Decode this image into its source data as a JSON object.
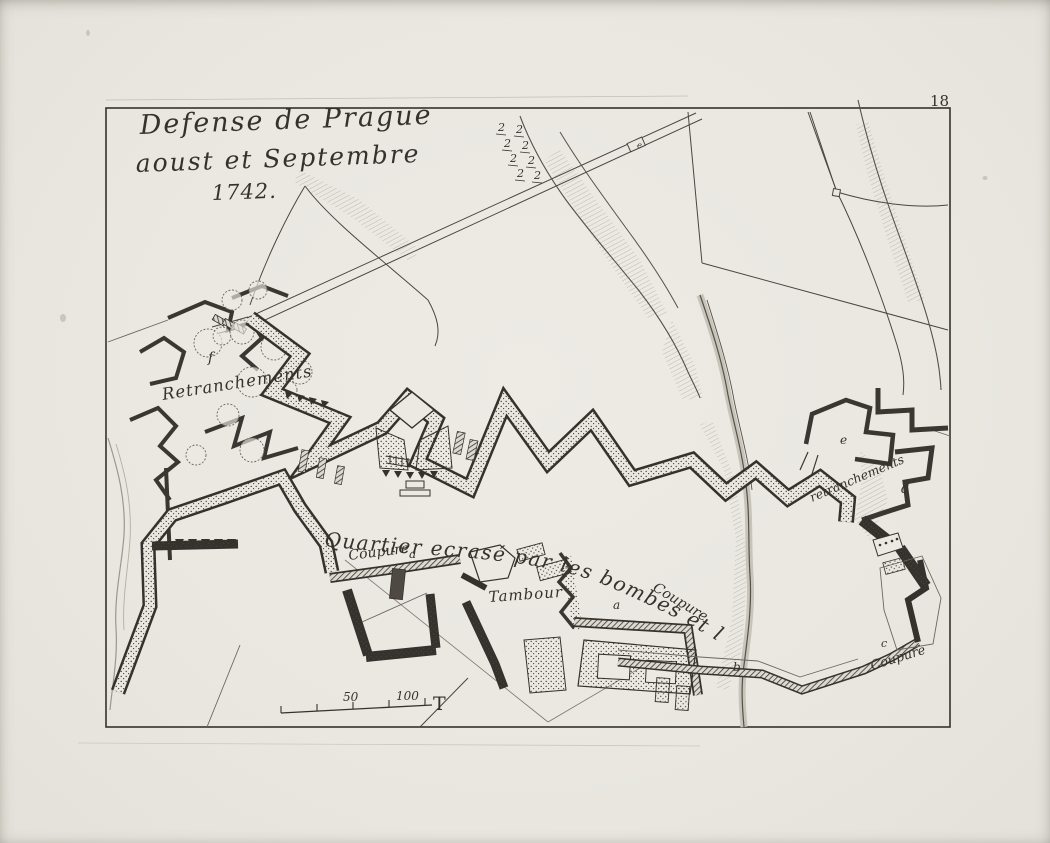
{
  "page": {
    "number": "18"
  },
  "title": {
    "line1": "Defense de Prague",
    "line2": "aoust et Septembre",
    "line3": "1742."
  },
  "labels": {
    "retranchements_left": "Retranchements",
    "retranchements_right": "retranchements",
    "quartier": "Quartier ecrasé par les bombes et le Canon",
    "coupure": "Coupure",
    "tambour": "Tambour"
  },
  "markers": {
    "a": "a",
    "b": "b",
    "c": "c",
    "d": "d",
    "e": "e",
    "f": "f"
  },
  "scale": {
    "fifty": "50",
    "hundred": "100",
    "t": "T"
  },
  "symbols": {
    "battery": "2"
  },
  "colors": {
    "paper": "#eae8e1",
    "ink": "#35322e"
  }
}
